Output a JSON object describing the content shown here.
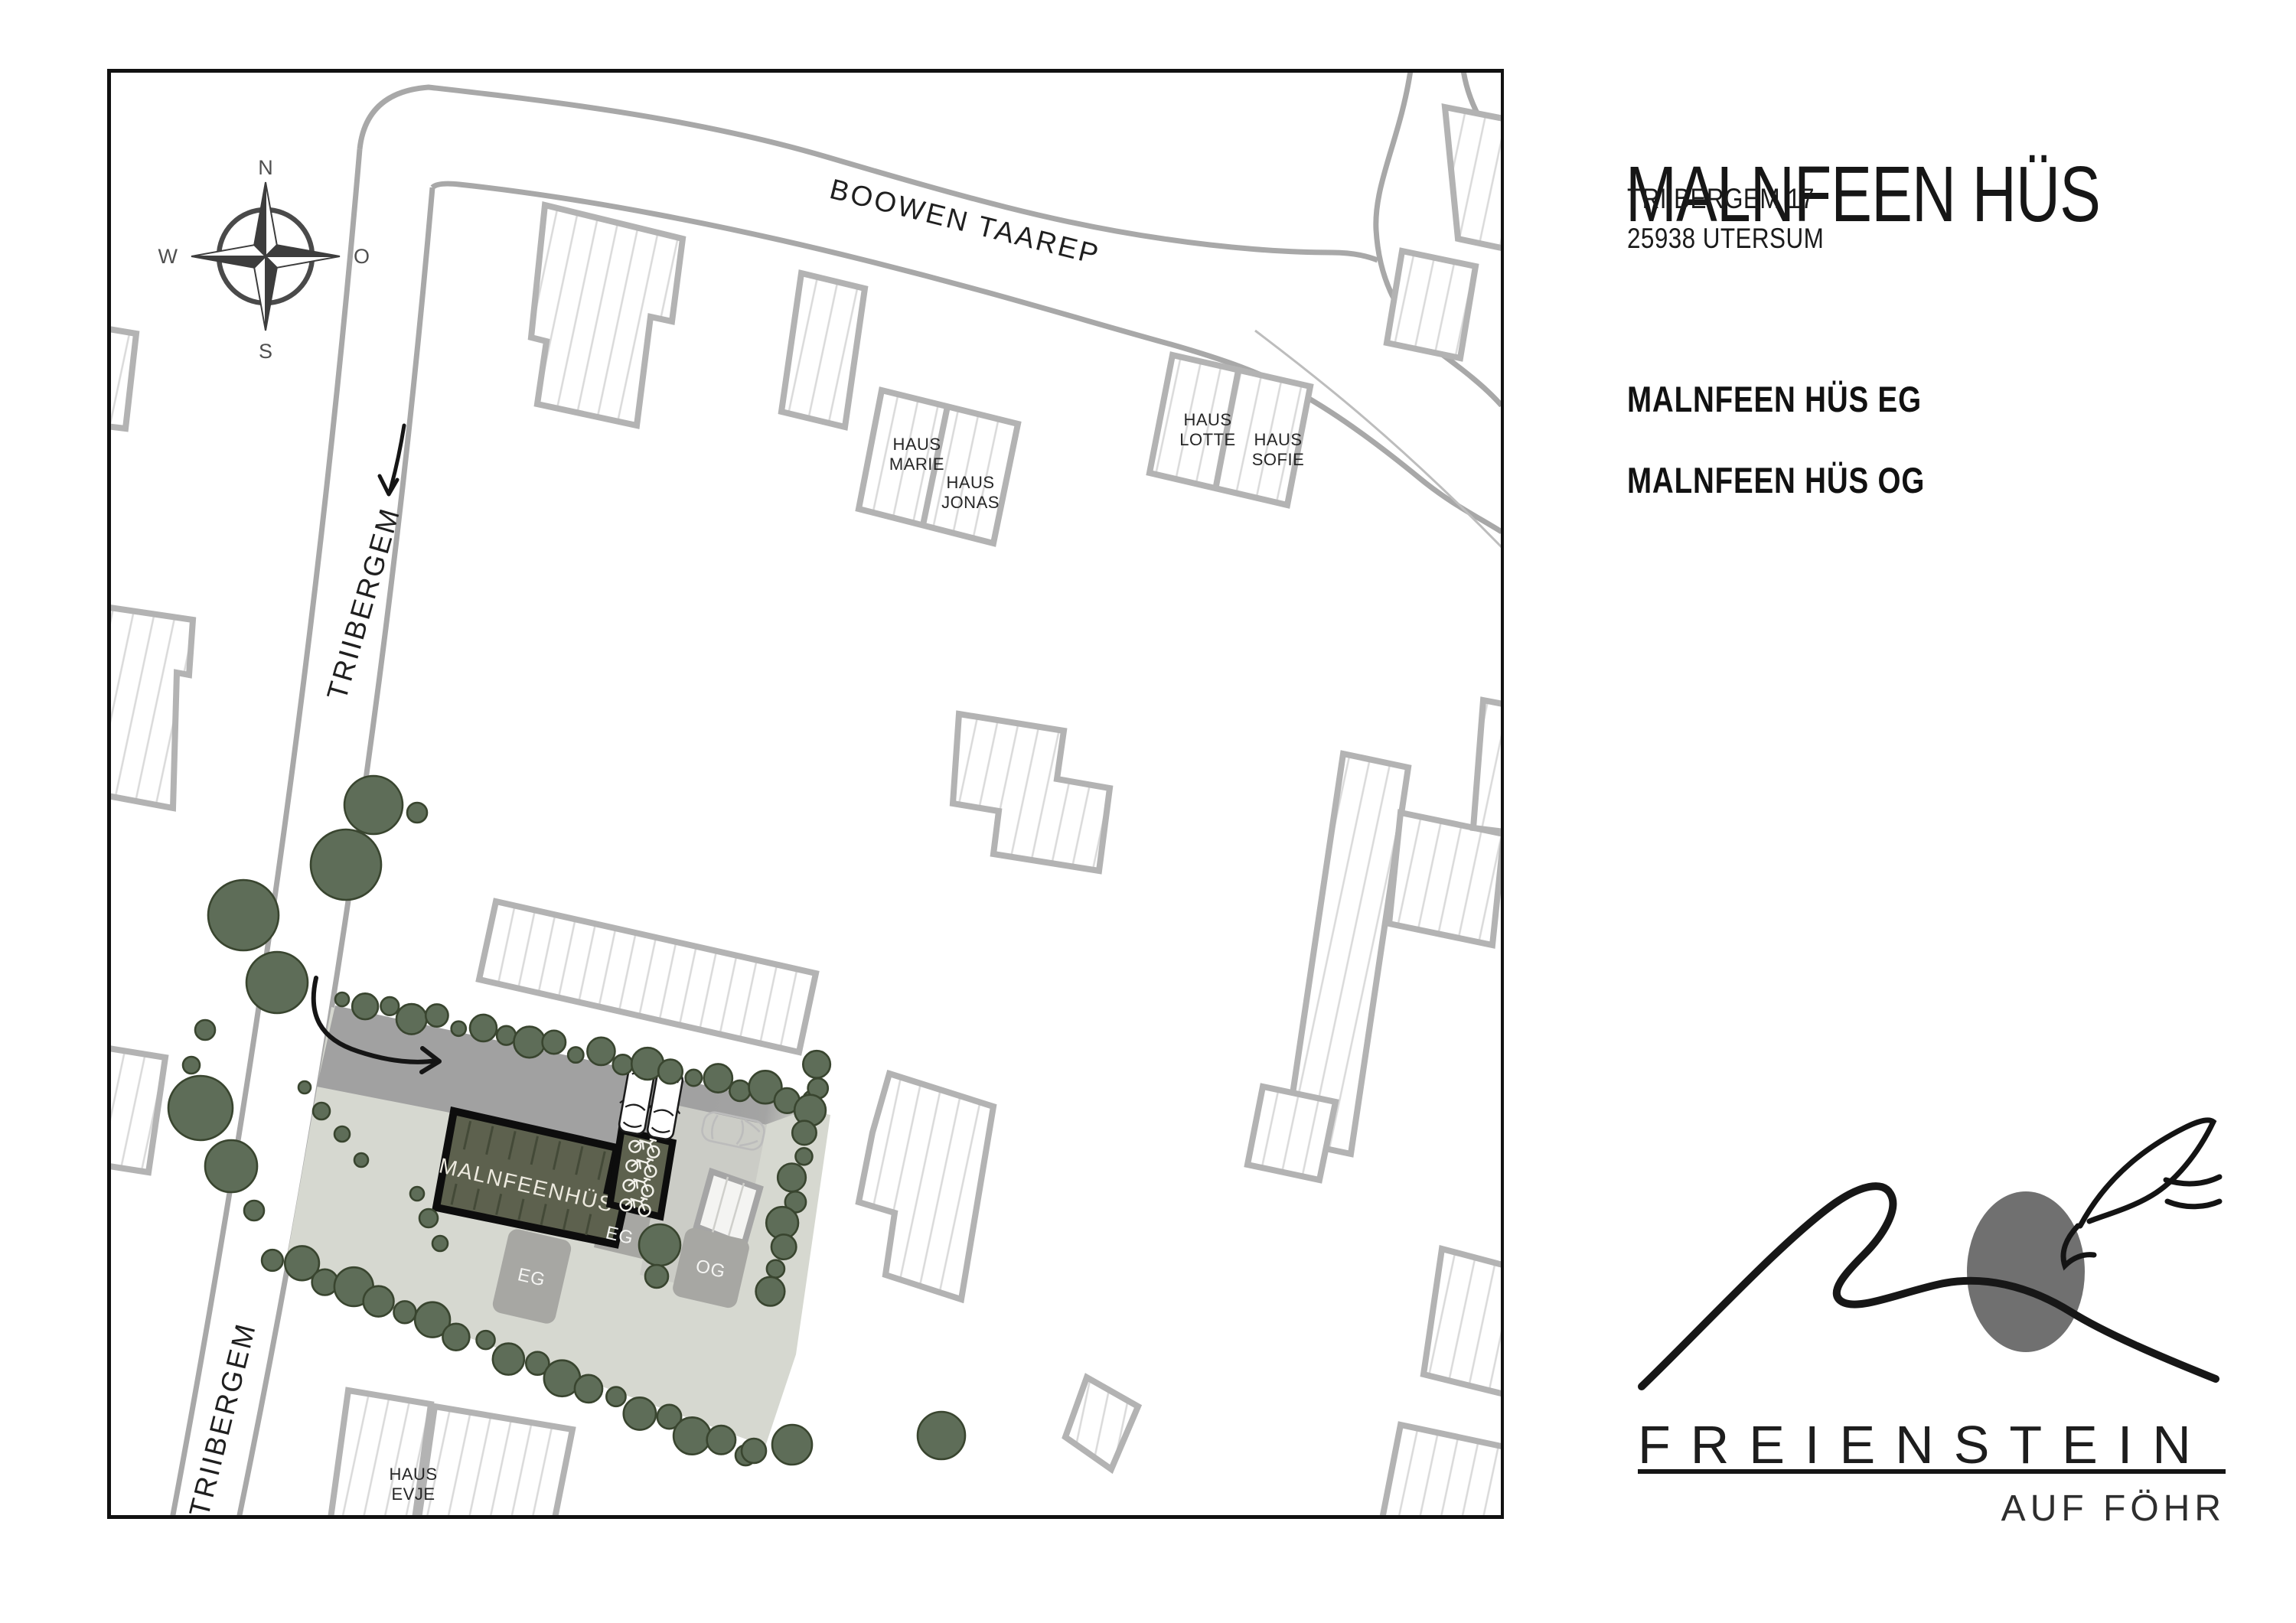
{
  "panel": {
    "title": "MALNFEEN HÜS",
    "address_line1": "TRIIBERGEM 17",
    "address_line2": "25938 UTERSUM",
    "link_eg": "MALNFEEN HÜS EG",
    "link_og": "MALNFEEN HÜS OG",
    "logo": {
      "brand": "FREIENSTEIN",
      "tagline": "AUF FÖHR"
    }
  },
  "map": {
    "compass": {
      "n": "N",
      "e": "O",
      "s": "S",
      "w": "W"
    },
    "streets": {
      "boowen": "BOOWEN TAAREP",
      "triibergem": "TRIIBERGEM"
    },
    "site": {
      "building_label": "MALNFEENHÜS",
      "badge_eg": "EG",
      "badge_og": "OG"
    },
    "houses": {
      "marie": {
        "l1": "HAUS",
        "l2": "MARIE"
      },
      "jonas": {
        "l1": "HAUS",
        "l2": "JONAS"
      },
      "lotte": {
        "l1": "HAUS",
        "l2": "LOTTE"
      },
      "sofie": {
        "l1": "HAUS",
        "l2": "SOFIE"
      },
      "evje": {
        "l1": "HAUS",
        "l2": "EVJE"
      }
    },
    "colors": {
      "tree": "#5e6d58",
      "tree_outline": "#39452f",
      "plot": "#d6d8d0",
      "patio": "#cbccc6",
      "site_building": "#5d614e",
      "driveway": "#a1a1a1",
      "badge": "#a7a7a3",
      "street": "#a8a8a8",
      "building_outline": "#b3b3b3"
    }
  }
}
